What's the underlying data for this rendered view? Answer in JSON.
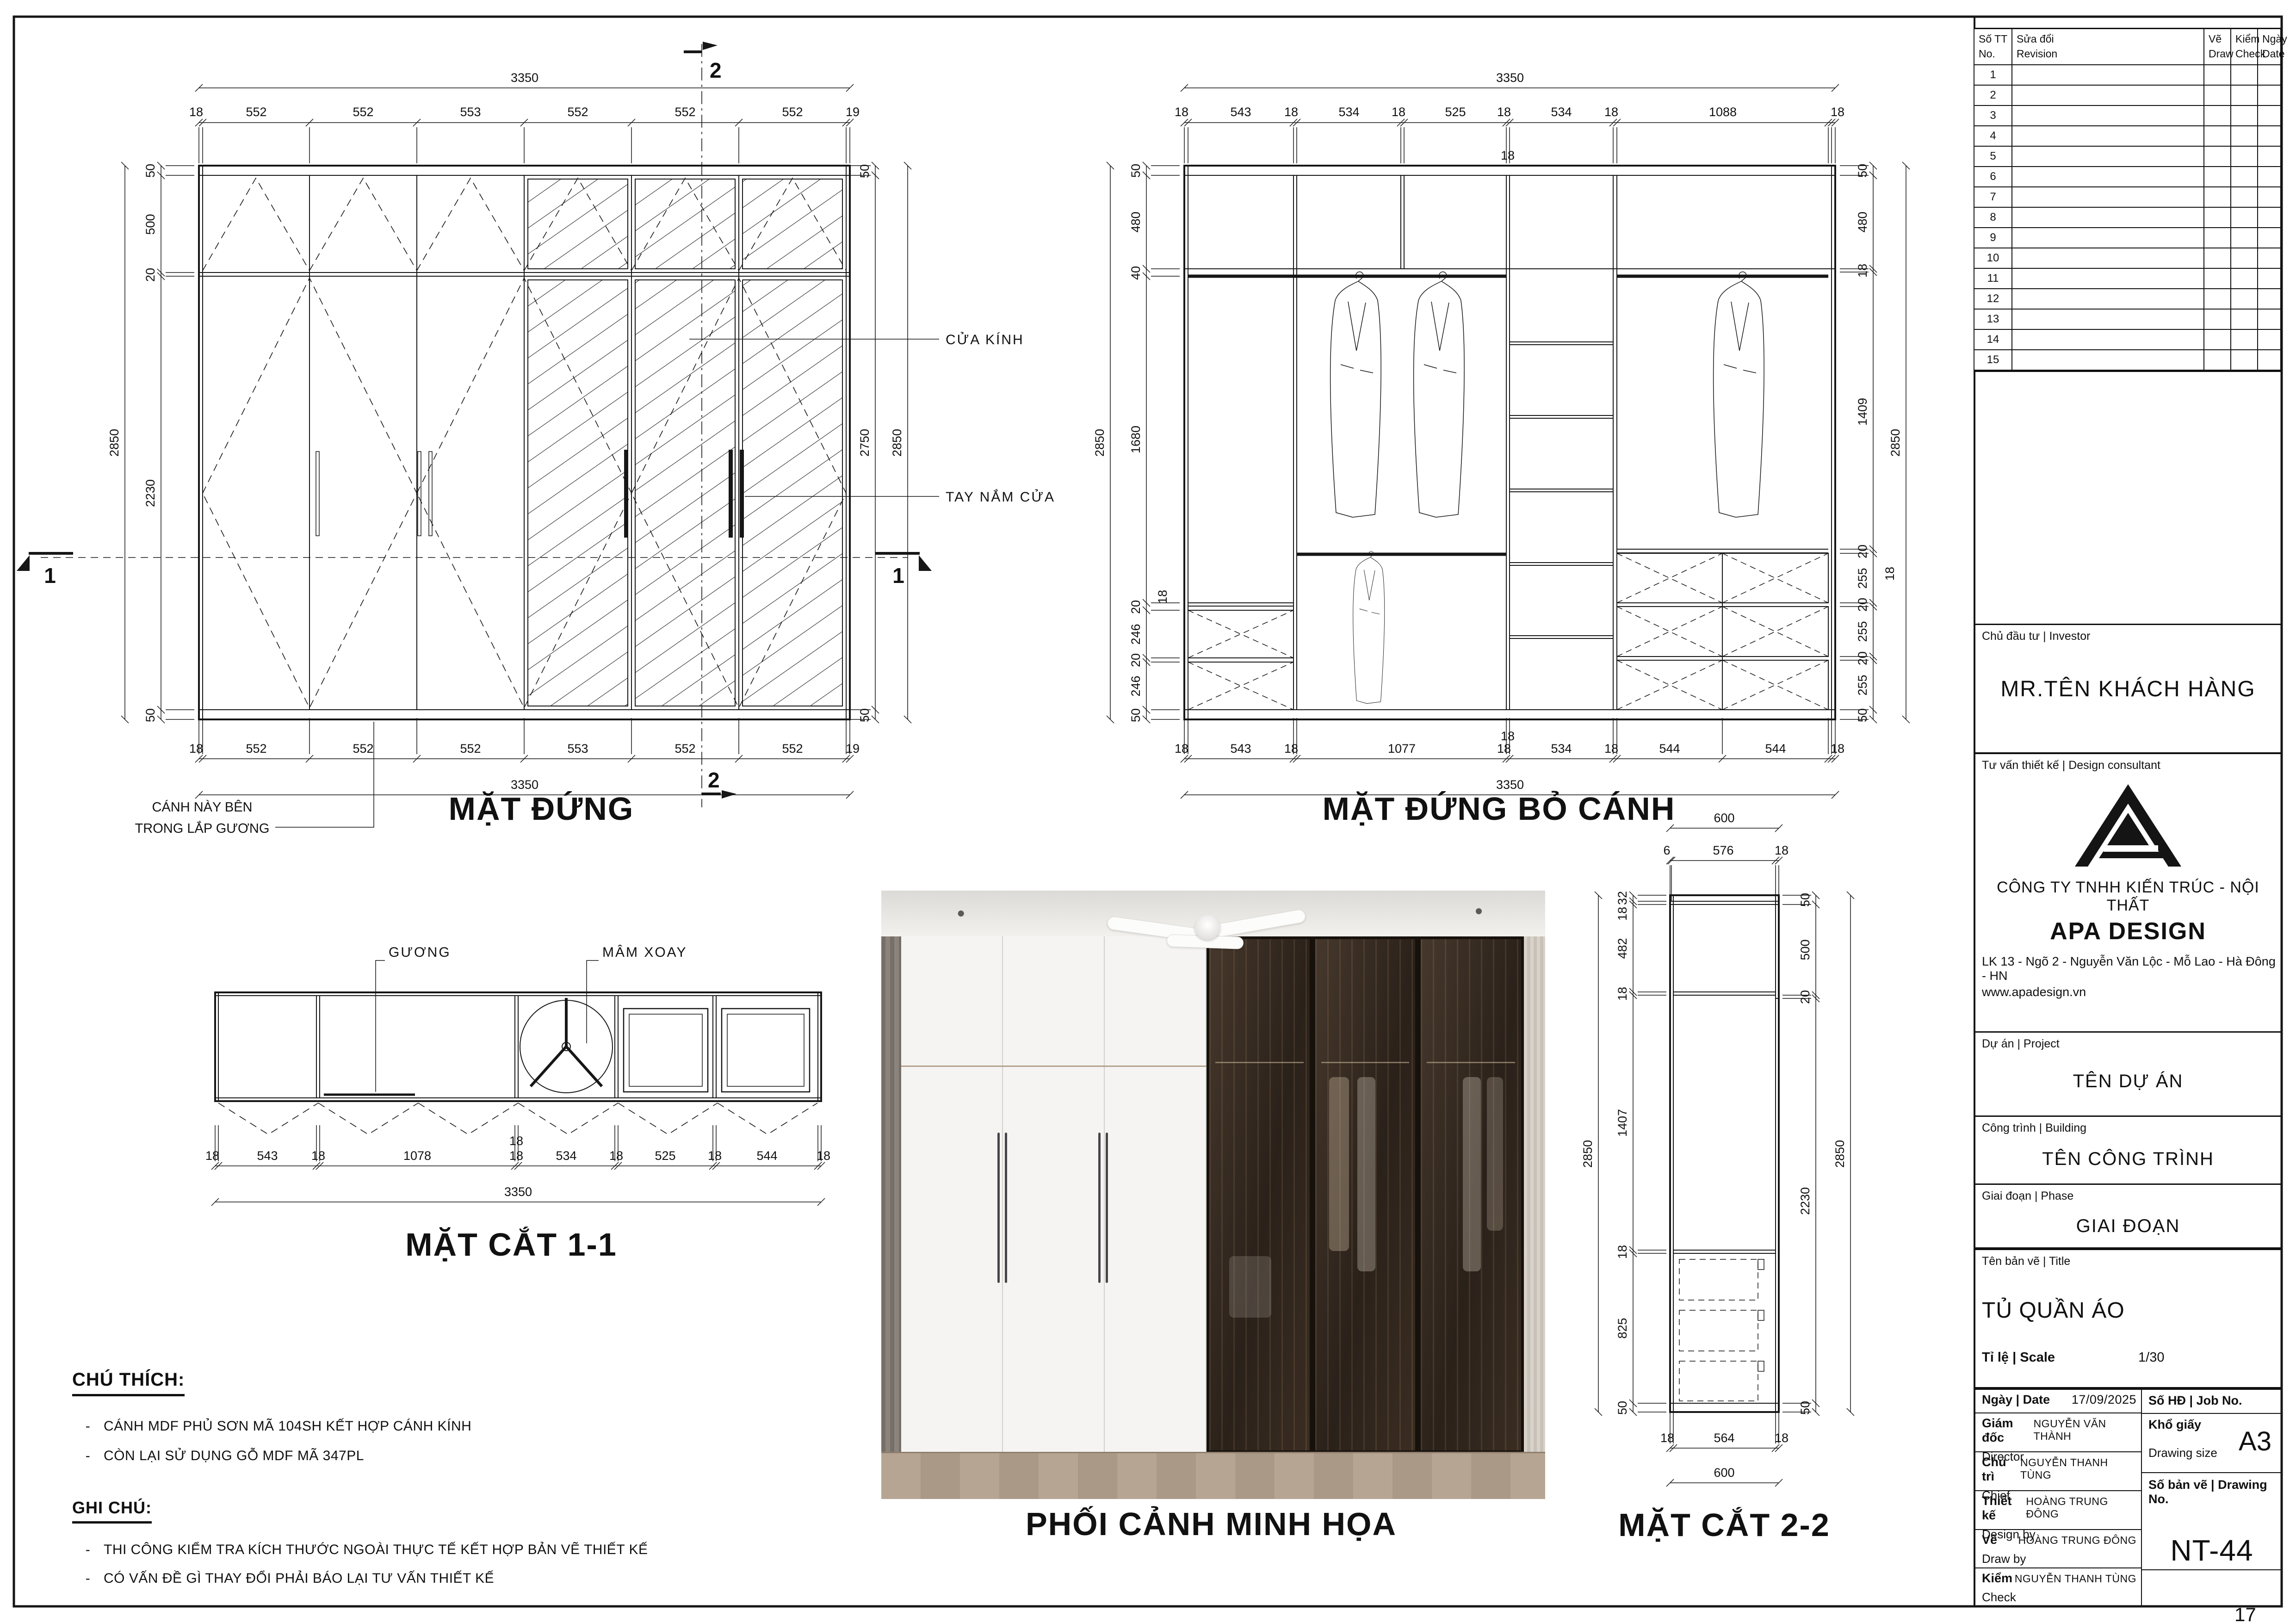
{
  "sheet": {
    "page": "17"
  },
  "fe": {
    "title": "MẶT ĐỨNG",
    "ov_w": "3350",
    "ov_h": "2850",
    "top": [
      "18",
      "552",
      "552",
      "553",
      "552",
      "552",
      "552",
      "19"
    ],
    "bottom": [
      "18",
      "552",
      "552",
      "552",
      "553",
      "552",
      "552",
      "19"
    ],
    "left": [
      "50",
      "500",
      "20",
      "2230",
      "50"
    ],
    "right_top": "50",
    "right_span": "2750",
    "right_bottom": "50",
    "marker_1": "1",
    "marker_2": "2",
    "lbl_glass": "CỬA KÍNH",
    "lbl_handle": "TAY NẮM CỬA",
    "note_line1": "CÁNH NÀY BÊN",
    "note_line2": "TRONG LẮP GƯƠNG"
  },
  "re": {
    "title": "MẶT ĐỨNG BỎ CÁNH",
    "ov_w": "3350",
    "ov_h": "2850",
    "top": [
      "18",
      "543",
      "18",
      "534",
      "18",
      "525",
      "18",
      "534",
      "18",
      "1088",
      "18"
    ],
    "top_extra": "18",
    "bottom": [
      "18",
      "543",
      "18",
      "1077",
      "18",
      "534",
      "18",
      "544",
      "544",
      "18"
    ],
    "bottom_extra": "18",
    "left": [
      "50",
      "480",
      "40",
      "1680",
      "20",
      "246",
      "20",
      "246",
      "50"
    ],
    "left_extra": "18",
    "right": [
      "50",
      "480",
      "18",
      "1409",
      "20",
      "255",
      "20",
      "255",
      "20",
      "255",
      "50"
    ],
    "right_extra": "18"
  },
  "s1": {
    "title": "MẶT CẮT 1-1",
    "ov": "3350",
    "bottom": [
      "18",
      "543",
      "18",
      "1078",
      "18",
      "534",
      "18",
      "525",
      "18",
      "544",
      "18"
    ],
    "bottom_extra": "18",
    "lbl_mirror": "GƯƠNG",
    "lbl_tray": "MÂM XOAY"
  },
  "s2": {
    "title": "MẶT CẮT 2-2",
    "ov_top": "600",
    "ov_bottom": "600",
    "ov_h": "2850",
    "top": [
      "6",
      "576",
      "18"
    ],
    "left": [
      "32",
      "18",
      "482",
      "18",
      "1407",
      "18",
      "825",
      "50"
    ],
    "right": [
      "50",
      "500",
      "20",
      "2230",
      "50"
    ],
    "bottom": [
      "18",
      "564",
      "18"
    ]
  },
  "photo": {
    "title": "PHỐI CẢNH MINH HỌA"
  },
  "notes": {
    "bullet": "-",
    "legend_title": "CHÚ THÍCH:",
    "legend": [
      "CÁNH MDF PHỦ SƠN MÃ 104SH KẾT HỢP CÁNH KÍNH",
      "CÒN LẠI SỬ DỤNG GỖ MDF MÃ 347PL"
    ],
    "note_title": "GHI CHÚ:",
    "items": [
      "THI CÔNG KIỂM TRA KÍCH THƯỚC NGOÀI THỰC TẾ KẾT HỢP BẢN VẼ THIẾT KẾ",
      "CÓ VẤN ĐỀ GÌ THAY ĐỔI PHẢI BÁO LẠI TƯ VẤN THIẾT KẾ"
    ]
  },
  "tb": {
    "rev": {
      "no_vi": "Số TT",
      "no_en": "No.",
      "rev_vi": "Sửa đổi",
      "rev_en": "Revision",
      "draw_vi": "Vẽ",
      "draw_en": "Draw",
      "check_vi": "Kiểm",
      "check_en": "Check",
      "date_vi": "Ngày",
      "date_en": "Date",
      "rows": [
        "1",
        "2",
        "3",
        "4",
        "5",
        "6",
        "7",
        "8",
        "9",
        "10",
        "11",
        "12",
        "13",
        "14",
        "15"
      ]
    },
    "investor_label": "Chủ đầu tư | Investor",
    "investor": "MR.TÊN KHÁCH HÀNG",
    "consultant_label": "Tư vấn thiết kế | Design consultant",
    "company_line1": "CÔNG TY TNHH KIẾN TRÚC - NỘI THẤT",
    "company_line2": "APA DESIGN",
    "address": "LK 13 - Ngõ 2 - Nguyễn Văn Lộc - Mỗ Lao - Hà Đông - HN",
    "website": "www.apadesign.vn",
    "project_label": "Dự án | Project",
    "project": "TÊN DỰ ÁN",
    "building_label": "Công trình | Building",
    "building": "TÊN CÔNG TRÌNH",
    "phase_label": "Giai đoạn | Phase",
    "phase": "GIAI ĐOẠN",
    "title_label": "Tên bản vẽ | Title",
    "drawing_title": "TỦ QUẦN ÁO",
    "scale_label": "Tỉ lệ | Scale",
    "scale": "1/30",
    "date_label": "Ngày | Date",
    "date": "17/09/2025",
    "job_label": "Số HĐ | Job No.",
    "director_vi": "Giám đốc",
    "director_en": "Director",
    "director": "NGUYỄN VĂN THÀNH",
    "paper_vi": "Khổ giấy",
    "paper_en": "Drawing size",
    "paper": "A3",
    "chief_vi": "Chủ trì",
    "chief_en": "Chief",
    "chief": "NGUYỄN THANH TÙNG",
    "dwgno_label": "Số bản vẽ | Drawing No.",
    "dwgno": "NT-44",
    "design_vi": "Thiết kế",
    "design_en": "Design by",
    "designer": "HOÀNG TRUNG ĐÔNG",
    "draw_vi": "Vẽ",
    "draw_en": "Draw by",
    "drawer": "HOÀNG TRUNG ĐÔNG",
    "check_vi": "Kiểm",
    "check_en": "Check",
    "checker": "NGUYỄN THANH TÙNG"
  }
}
